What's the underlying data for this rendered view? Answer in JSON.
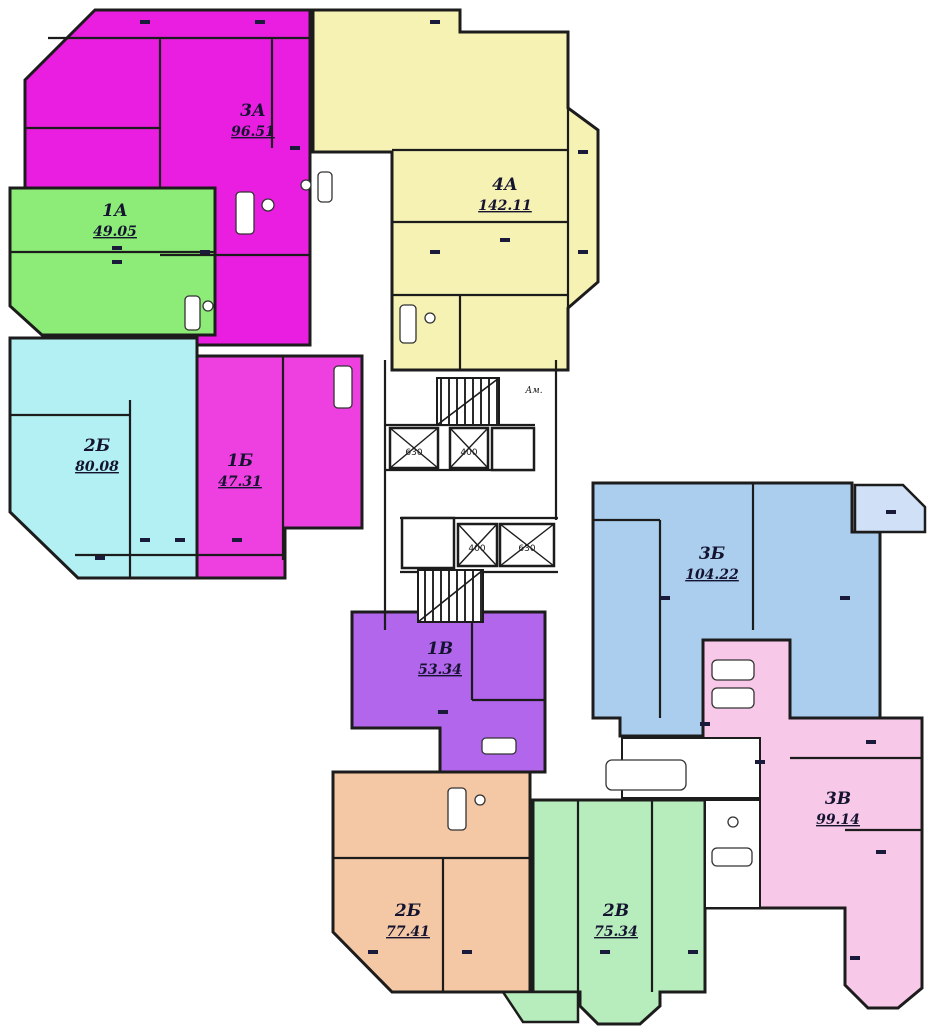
{
  "plan": {
    "background": "#ffffff",
    "wall_color": "#1c1c1c",
    "apartments": [
      {
        "code": "3А",
        "area": "96.51",
        "color": "#e91ee0"
      },
      {
        "code": "4А",
        "area": "142.11",
        "color": "#f6f2b4"
      },
      {
        "code": "1А",
        "area": "49.05",
        "color": "#8dec77"
      },
      {
        "code": "2Б",
        "area": "80.08",
        "color": "#b2f0f3"
      },
      {
        "code": "1Б",
        "area": "47.31",
        "color": "#ee3fe0"
      },
      {
        "code": "1В",
        "area": "53.34",
        "color": "#b266ec"
      },
      {
        "code": "3Б",
        "area": "104.22",
        "color": "#abceef",
        "balcony_color": "#cfe0f7"
      },
      {
        "code": "3В",
        "area": "99.14",
        "color": "#f8c8e9"
      },
      {
        "code": "2Б",
        "area": "77.41",
        "color": "#f5c8a5"
      },
      {
        "code": "2В",
        "area": "75.34",
        "color": "#b7ecbc"
      }
    ],
    "elevators": [
      {
        "capacity": "630"
      },
      {
        "capacity": "400"
      },
      {
        "capacity": "400"
      },
      {
        "capacity": "630"
      }
    ],
    "labels": {
      "core": "Ам."
    }
  }
}
